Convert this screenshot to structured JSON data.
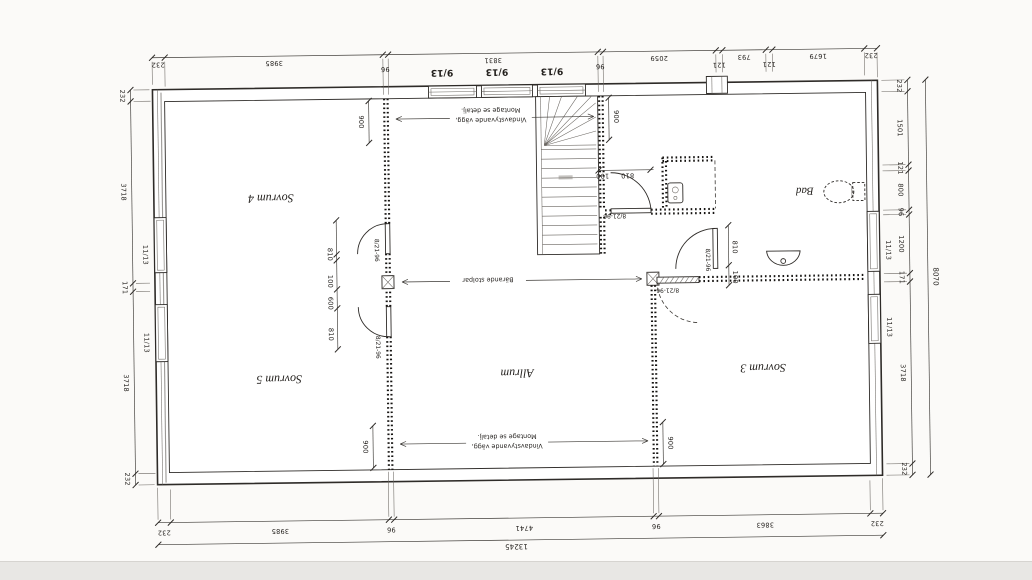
{
  "plan": {
    "rooms": {
      "sovrum4": "Sovrum 4",
      "sovrum5": "Sovrum 5",
      "sovrum3": "Sovrum 3",
      "allrum": "Allrum",
      "bad": "Bad"
    },
    "windows": {
      "top_label": "9/13",
      "side_label": "11/13"
    },
    "doors": {
      "label": "8/21-96"
    },
    "notes": {
      "wind1": "Vindavstyvande vägg,",
      "wind2": "Montage se detalj.",
      "posts": "Bärande stolpar"
    },
    "dims": {
      "top": [
        "232",
        "3985",
        "96",
        "3831",
        "96",
        "2059",
        "121",
        "793",
        "121",
        "1679",
        "232"
      ],
      "bottom": [
        "232",
        "3985",
        "96",
        "4741",
        "96",
        "3863",
        "232"
      ],
      "left": [
        "232",
        "3718",
        "171",
        "3718",
        "232"
      ],
      "right": [
        "232",
        "1501",
        "121",
        "800",
        "96",
        "1200",
        "171",
        "3718",
        "232"
      ],
      "total_width": "13245",
      "total_height": "8070",
      "o900": "900",
      "o810": "810",
      "o100": "100",
      "o600": "600"
    }
  }
}
